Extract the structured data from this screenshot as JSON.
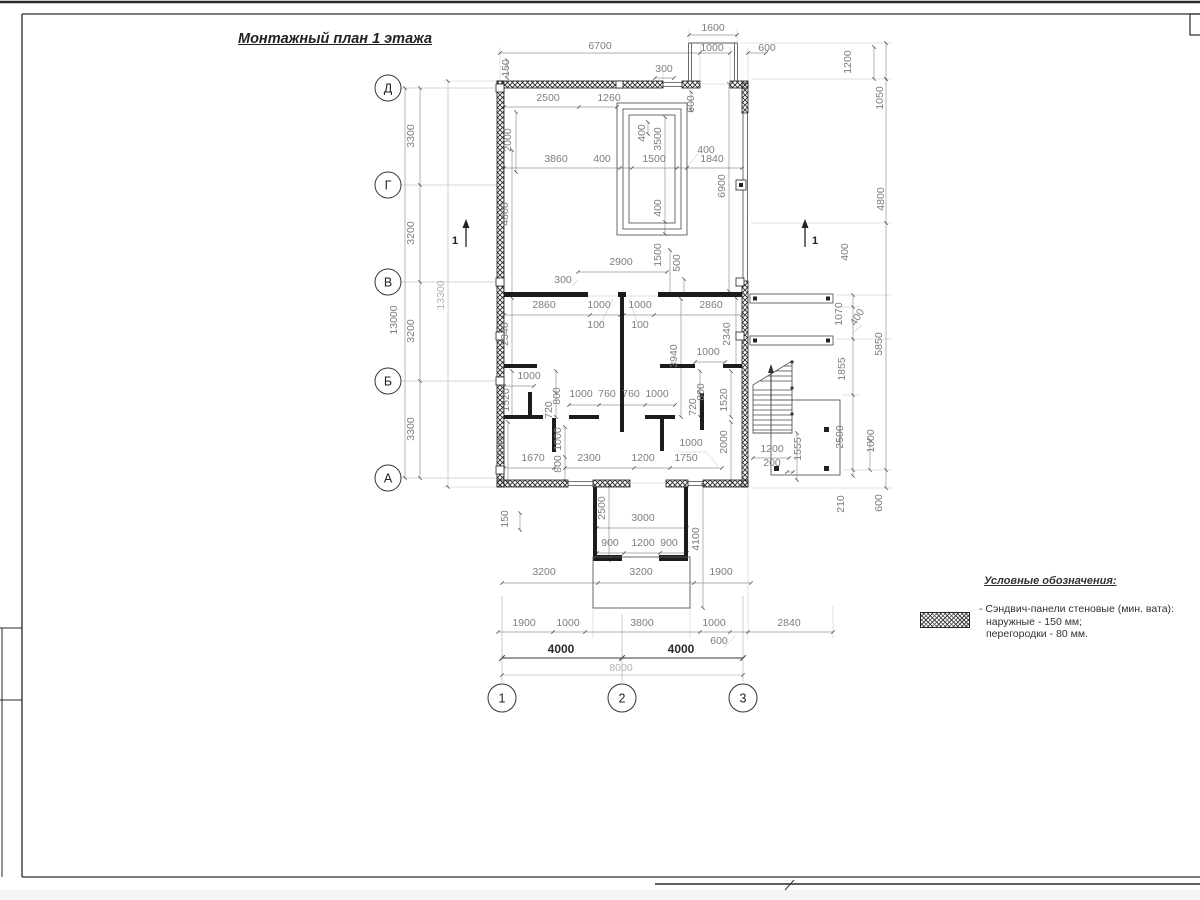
{
  "sheet": {
    "title": "Монтажный план 1 этажа"
  },
  "axes": {
    "rows": [
      "Д",
      "Г",
      "В",
      "Б",
      "А"
    ],
    "cols": [
      "1",
      "2",
      "3"
    ],
    "section_label": "1"
  },
  "legend": {
    "title": "Условные обозначения:",
    "items": [
      "- Сэндвич-панели стеновые (мин. вата):",
      "наружные - 150 мм;",
      "перегородки - 80 мм."
    ]
  },
  "colors": {
    "wall": "#1a1a1a",
    "dim_line": "#949494",
    "dim_text": "#7d7d7d",
    "dark_text": "#222222",
    "light_text": "#b2b2b2"
  },
  "plan_labels": [
    {
      "t": "1600",
      "x": 713,
      "y": 31
    },
    {
      "t": "6700",
      "x": 600,
      "y": 49
    },
    {
      "t": "1000",
      "x": 712,
      "y": 51
    },
    {
      "t": "600",
      "x": 767,
      "y": 51
    },
    {
      "t": "300",
      "x": 664,
      "y": 72
    },
    {
      "t": "150",
      "x": 509,
      "y": 68,
      "r": -90
    },
    {
      "t": "3300",
      "x": 414,
      "y": 136,
      "r": -90
    },
    {
      "t": "3200",
      "x": 414,
      "y": 233,
      "r": -90
    },
    {
      "t": "3200",
      "x": 414,
      "y": 331,
      "r": -90
    },
    {
      "t": "3300",
      "x": 414,
      "y": 429,
      "r": -90
    },
    {
      "t": "13000",
      "x": 397,
      "y": 320,
      "r": -90
    },
    {
      "t": "13300",
      "x": 444,
      "y": 295,
      "r": -90,
      "c": "light"
    },
    {
      "t": "2500",
      "x": 548,
      "y": 101
    },
    {
      "t": "1260",
      "x": 609,
      "y": 101
    },
    {
      "t": "2000",
      "x": 511,
      "y": 140,
      "r": -90
    },
    {
      "t": "3860",
      "x": 556,
      "y": 162
    },
    {
      "t": "400",
      "x": 602,
      "y": 162
    },
    {
      "t": "1500",
      "x": 654,
      "y": 162
    },
    {
      "t": "1840",
      "x": 712,
      "y": 162
    },
    {
      "t": "400",
      "x": 706,
      "y": 153
    },
    {
      "t": "600",
      "x": 694,
      "y": 104,
      "r": -90
    },
    {
      "t": "400",
      "x": 645,
      "y": 133,
      "r": -90
    },
    {
      "t": "3500",
      "x": 661,
      "y": 139,
      "r": -90
    },
    {
      "t": "400",
      "x": 661,
      "y": 208,
      "r": -90
    },
    {
      "t": "4800",
      "x": 508,
      "y": 214,
      "r": -90
    },
    {
      "t": "6900",
      "x": 725,
      "y": 186,
      "r": -90
    },
    {
      "t": "2900",
      "x": 621,
      "y": 265
    },
    {
      "t": "300",
      "x": 563,
      "y": 283
    },
    {
      "t": "1500",
      "x": 661,
      "y": 255,
      "r": -90
    },
    {
      "t": "500",
      "x": 680,
      "y": 263,
      "r": -90
    },
    {
      "t": "2860",
      "x": 544,
      "y": 308
    },
    {
      "t": "1000",
      "x": 599,
      "y": 308
    },
    {
      "t": "1000",
      "x": 640,
      "y": 308
    },
    {
      "t": "2860",
      "x": 711,
      "y": 308
    },
    {
      "t": "100",
      "x": 596,
      "y": 328
    },
    {
      "t": "100",
      "x": 640,
      "y": 328
    },
    {
      "t": "2340",
      "x": 508,
      "y": 334,
      "r": -90
    },
    {
      "t": "2340",
      "x": 730,
      "y": 334,
      "r": -90
    },
    {
      "t": "3940",
      "x": 677,
      "y": 356,
      "r": -90
    },
    {
      "t": "1000",
      "x": 708,
      "y": 355
    },
    {
      "t": "1000",
      "x": 529,
      "y": 379
    },
    {
      "t": "1520",
      "x": 509,
      "y": 400,
      "r": -90
    },
    {
      "t": "720",
      "x": 552,
      "y": 410,
      "r": -90
    },
    {
      "t": "800",
      "x": 560,
      "y": 396,
      "r": -90
    },
    {
      "t": "1000",
      "x": 581,
      "y": 397
    },
    {
      "t": "760",
      "x": 607,
      "y": 397
    },
    {
      "t": "760",
      "x": 631,
      "y": 397
    },
    {
      "t": "1000",
      "x": 657,
      "y": 397
    },
    {
      "t": "720",
      "x": 696,
      "y": 407,
      "r": -90
    },
    {
      "t": "800",
      "x": 704,
      "y": 392,
      "r": -90
    },
    {
      "t": "1520",
      "x": 727,
      "y": 400,
      "r": -90
    },
    {
      "t": "2000",
      "x": 504,
      "y": 444,
      "r": -90
    },
    {
      "t": "1670",
      "x": 533,
      "y": 461
    },
    {
      "t": "1000",
      "x": 561,
      "y": 439,
      "r": -90
    },
    {
      "t": "800",
      "x": 561,
      "y": 464,
      "r": -90
    },
    {
      "t": "2300",
      "x": 589,
      "y": 461
    },
    {
      "t": "1200",
      "x": 643,
      "y": 461
    },
    {
      "t": "1750",
      "x": 686,
      "y": 461
    },
    {
      "t": "1000",
      "x": 691,
      "y": 446
    },
    {
      "t": "2000",
      "x": 727,
      "y": 442,
      "r": -90
    },
    {
      "t": "150",
      "x": 508,
      "y": 519,
      "r": -90
    },
    {
      "t": "2500",
      "x": 605,
      "y": 508,
      "r": -90
    },
    {
      "t": "3000",
      "x": 643,
      "y": 521
    },
    {
      "t": "900",
      "x": 610,
      "y": 546
    },
    {
      "t": "1200",
      "x": 643,
      "y": 546
    },
    {
      "t": "900",
      "x": 669,
      "y": 546
    },
    {
      "t": "4100",
      "x": 699,
      "y": 539,
      "r": -90
    },
    {
      "t": "1200",
      "x": 772,
      "y": 452
    },
    {
      "t": "200",
      "x": 772,
      "y": 466
    },
    {
      "t": "1555",
      "x": 801,
      "y": 449,
      "r": -90
    },
    {
      "t": "3200",
      "x": 544,
      "y": 575
    },
    {
      "t": "3200",
      "x": 641,
      "y": 575
    },
    {
      "t": "1900",
      "x": 721,
      "y": 575
    },
    {
      "t": "1900",
      "x": 524,
      "y": 626
    },
    {
      "t": "1000",
      "x": 568,
      "y": 626
    },
    {
      "t": "3800",
      "x": 642,
      "y": 626
    },
    {
      "t": "1000",
      "x": 714,
      "y": 626
    },
    {
      "t": "600",
      "x": 719,
      "y": 644
    },
    {
      "t": "2840",
      "x": 789,
      "y": 626
    },
    {
      "t": "4000",
      "x": 561,
      "y": 653,
      "c": "dark"
    },
    {
      "t": "4000",
      "x": 681,
      "y": 653,
      "c": "dark"
    },
    {
      "t": "8000",
      "x": 621,
      "y": 671,
      "c": "light"
    },
    {
      "t": "1200",
      "x": 851,
      "y": 62,
      "r": -90
    },
    {
      "t": "1050",
      "x": 883,
      "y": 98,
      "r": -90
    },
    {
      "t": "4800",
      "x": 884,
      "y": 199,
      "r": -90
    },
    {
      "t": "400",
      "x": 848,
      "y": 252,
      "r": -90
    },
    {
      "t": "1070",
      "x": 842,
      "y": 314,
      "r": -90
    },
    {
      "t": "400",
      "x": 860,
      "y": 319,
      "r": -58
    },
    {
      "t": "1855",
      "x": 845,
      "y": 369,
      "r": -90
    },
    {
      "t": "2500",
      "x": 843,
      "y": 437,
      "r": -90
    },
    {
      "t": "210",
      "x": 844,
      "y": 504,
      "r": -90
    },
    {
      "t": "5850",
      "x": 882,
      "y": 344,
      "r": -90
    },
    {
      "t": "1000",
      "x": 874,
      "y": 441,
      "r": -90
    },
    {
      "t": "600",
      "x": 882,
      "y": 503,
      "r": -90
    }
  ]
}
